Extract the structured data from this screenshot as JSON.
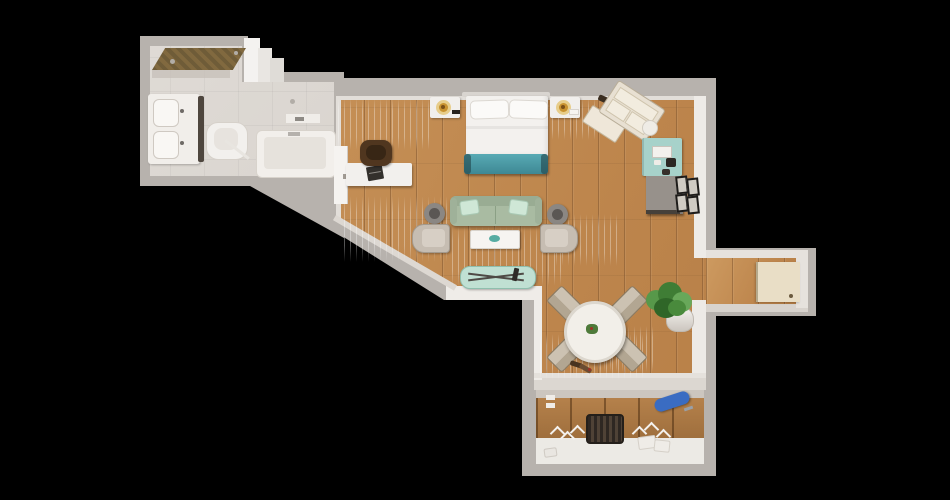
{
  "scene": {
    "description": "Top-down 3D render of a studio-suite floor plan on a black background",
    "background_color": "#000000"
  },
  "palette": {
    "wall": "#b7b2ad",
    "wall_face": "#edeae6",
    "wood_floor": "#c08a52",
    "bathroom_floor": "#d7d1ca",
    "shower_ceiling": "#6f5c38",
    "bed_linen": "#f3f1ee",
    "bench_teal": "#4aa0ac",
    "sofa_sage": "#a9bba2",
    "pillow_mint": "#cfe7d6",
    "armchair_beige": "#c6bdb2",
    "lamp_gold": "#c8922f",
    "kitchenette_mint": "#a7d2ca",
    "fridge_gray": "#97918b",
    "dining_chair_taupe": "#ccc2b2",
    "plant_green": "#4c8c3e",
    "ironing_board_blue": "#3a6cc2",
    "door_cream": "#e9dec6",
    "suitcase_cream": "#e8e0d2",
    "desk_chair_brown": "#50361f"
  },
  "rooms": [
    {
      "id": "bathroom",
      "label": "Bathroom"
    },
    {
      "id": "bedroom",
      "label": "Bedroom area"
    },
    {
      "id": "living",
      "label": "Living area"
    },
    {
      "id": "kitchenette",
      "label": "Kitchenette"
    },
    {
      "id": "dining",
      "label": "Dining area"
    },
    {
      "id": "entry",
      "label": "Entry hallway"
    },
    {
      "id": "closet",
      "label": "Closet"
    }
  ],
  "labels": {
    "vanity": "Double-sink vanity",
    "toilet": "Toilet",
    "bathtub": "Bathtub",
    "shower": "Walk-in shower",
    "bathroom_door": "Open bathroom door",
    "bed": "Double bed with pillows",
    "bench": "Teal bed-end bench",
    "nightstand_left": "Nightstand with gold lamp",
    "nightstand_right": "Nightstand with gold lamp",
    "suitcase": "Open suitcase on luggage rack",
    "pouf": "Small round pouf",
    "desk": "Work desk with laptop",
    "desk_chair": "Brown office chair",
    "sofa": "Sage sofa with mint cushions",
    "armchair_left": "Armchair",
    "armchair_right": "Armchair",
    "coffee_table": "Coffee table with teal bowl",
    "side_table_left": "Round side table",
    "side_table_right": "Round side table",
    "window_bench": "Mint window bench",
    "minibar": "Mint mini-bar cabinet with coffee maker",
    "fridge": "Mini fridge cabinet",
    "wall_frames": "Framed prints on wall",
    "dining_table": "Round dining table with centerpiece",
    "dining_chair": "Dining chair",
    "plant": "Potted green plant",
    "entry_door": "Entrance door",
    "basket": "Dark wire basket",
    "hanger": "Clothes hanger",
    "ironing_board": "Blue wall-mounted ironing board",
    "step_stool": "Folding stool"
  }
}
